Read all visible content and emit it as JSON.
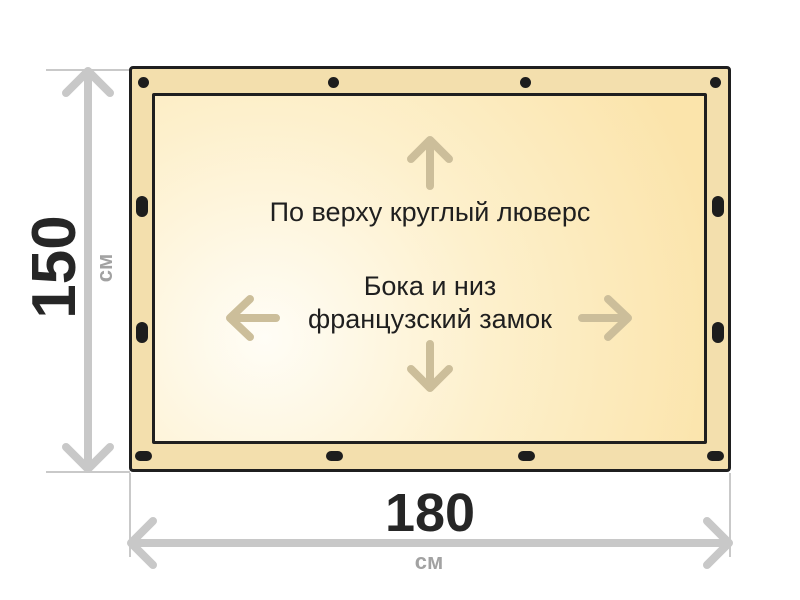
{
  "canvas": {
    "background": "#ffffff"
  },
  "tarp": {
    "top_label": "По верху круглый люверс",
    "center_label_line1": "Бока и низ",
    "center_label_line2": "французский замок",
    "fasteners": {
      "top": {
        "type": "круглый люверс",
        "shape": "circle",
        "count": 4
      },
      "left": {
        "type": "французский замок",
        "shape": "vertical-slot",
        "count": 2
      },
      "right": {
        "type": "французский замок",
        "shape": "vertical-slot",
        "count": 2
      },
      "bottom": {
        "type": "французский замок",
        "shape": "horizontal-slot",
        "count": 4
      }
    },
    "colors": {
      "outline": "#1f1f1f",
      "band": "#f3dfad",
      "panel_light": "#fffdf6",
      "panel_gold": "#fbe4ab",
      "fastener": "#1d1d1d",
      "content_arrow": "#ccbe9a"
    }
  },
  "dimensions": {
    "height": {
      "value": "150",
      "unit": "см"
    },
    "width": {
      "value": "180",
      "unit": "см"
    },
    "colors": {
      "arrow": "#c8c8c8",
      "extension_line": "#c9c9c9",
      "value_text": "#262626",
      "unit_text": "#a2a2a2"
    }
  }
}
